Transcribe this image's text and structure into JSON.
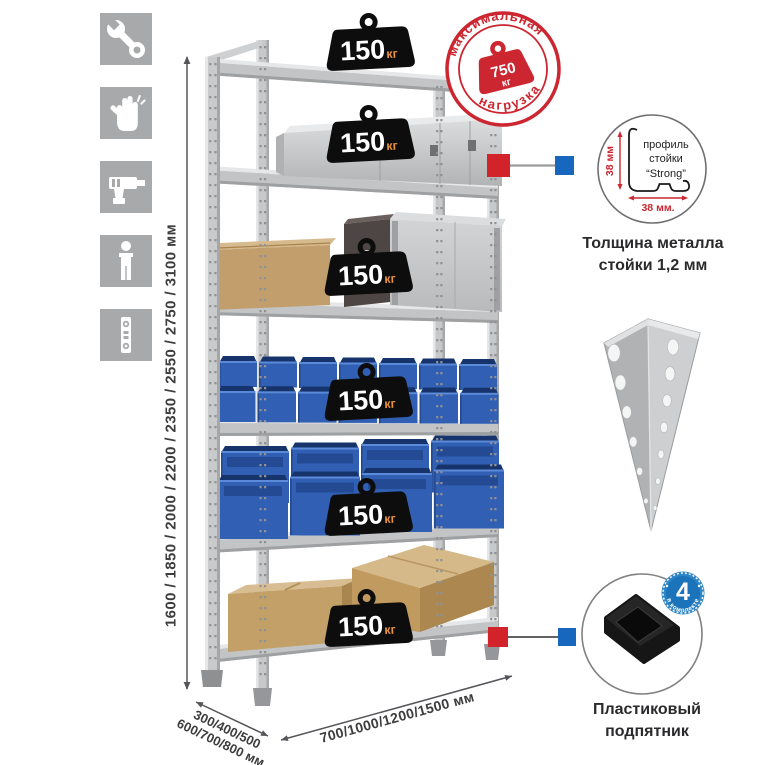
{
  "sidebar": {
    "icons": [
      {
        "name": "wrench"
      },
      {
        "name": "gloves"
      },
      {
        "name": "drill"
      },
      {
        "name": "person"
      },
      {
        "name": "level"
      }
    ]
  },
  "rack": {
    "shelf_loads": [
      {
        "value": "150",
        "unit": "кг"
      },
      {
        "value": "150",
        "unit": "кг"
      },
      {
        "value": "150",
        "unit": "кг"
      },
      {
        "value": "150",
        "unit": "кг"
      },
      {
        "value": "150",
        "unit": "кг"
      },
      {
        "value": "150",
        "unit": "кг"
      }
    ]
  },
  "stamp": {
    "arc_top": "максимальная",
    "arc_bottom": "нагрузка",
    "weight_value": "750",
    "weight_unit": "кг"
  },
  "dimensions": {
    "height_values": "1600 / 1850 / 2000 / 2200 / 2350 / 2550 / 2750 / 3100 мм",
    "depth_values_line1": "300/400/500",
    "depth_values_line2": "600/700/800 мм",
    "width_values": "700/1000/1200/1500 мм"
  },
  "profile_detail": {
    "label_line1": "профиль",
    "label_line2": "стойки",
    "label_line3": "“Strong”",
    "dim_vertical": "38 мм",
    "dim_horizontal": "38 мм.",
    "caption_line1": "Толщина металла",
    "caption_line2": "стойки 1,2 мм"
  },
  "foot_detail": {
    "badge_value": "4",
    "badge_arc": "в комплекте",
    "caption_line1": "Пластиковый",
    "caption_line2": "подпятник"
  },
  "colors": {
    "stamp_red": "#cc2630",
    "marker_red": "#d2232b",
    "marker_blue": "#1767be",
    "badge_blue": "#1b74ba",
    "bin_blue": "#315fb4",
    "metal_gray": "#c7c8ca",
    "icon_gray": "#a8a9ab"
  }
}
